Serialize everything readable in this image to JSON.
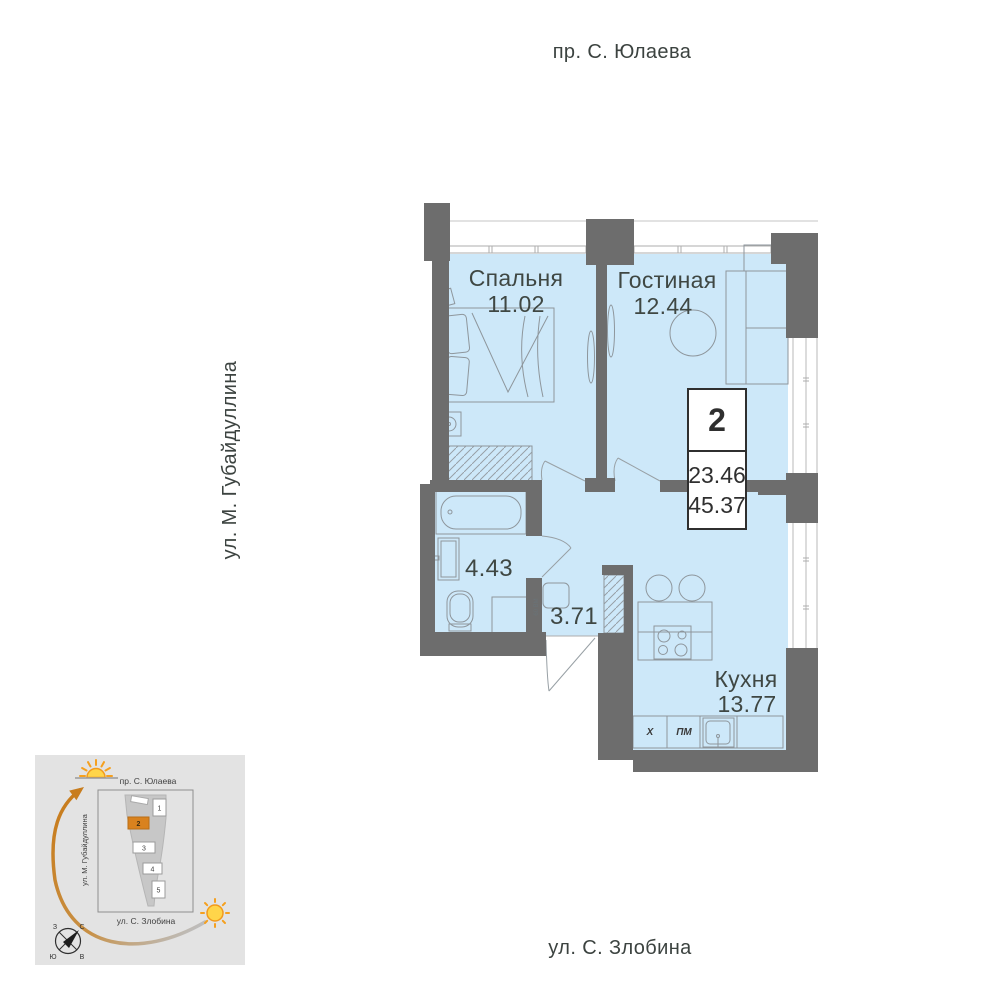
{
  "streets": {
    "top": "пр. С. Юлаева",
    "left": "ул. М. Губайдуллина",
    "bottom": "ул. С. Злобина"
  },
  "rooms": {
    "bedroom": {
      "label": "Спальня",
      "area": "11.02"
    },
    "living": {
      "label": "Гостиная",
      "area": "12.44"
    },
    "bathroom": {
      "area": "4.43"
    },
    "hall": {
      "area": "3.71"
    },
    "kitchen": {
      "label": "Кухня",
      "area": "13.77"
    }
  },
  "info_badge": {
    "rooms_count": "2",
    "living_area": "23.46",
    "total_area": "45.37"
  },
  "appliances": {
    "fridge_label": "Х",
    "dishwasher_label": "ПМ",
    "washer_label": "60 ВМ"
  },
  "minimap": {
    "streets": {
      "top": "пр. С. Юлаева",
      "left": "ул. М. Губайдуллина",
      "bottom": "ул. С. Злобина"
    },
    "blocks": [
      "1",
      "2",
      "3",
      "4",
      "5"
    ],
    "selected_block": "2",
    "compass": {
      "north": "С",
      "south": "Ю",
      "west": "З",
      "east": "В"
    }
  },
  "colors": {
    "room_fill": "#cde8f9",
    "wall": "#6d6d6d",
    "accent": "#d9821e"
  }
}
